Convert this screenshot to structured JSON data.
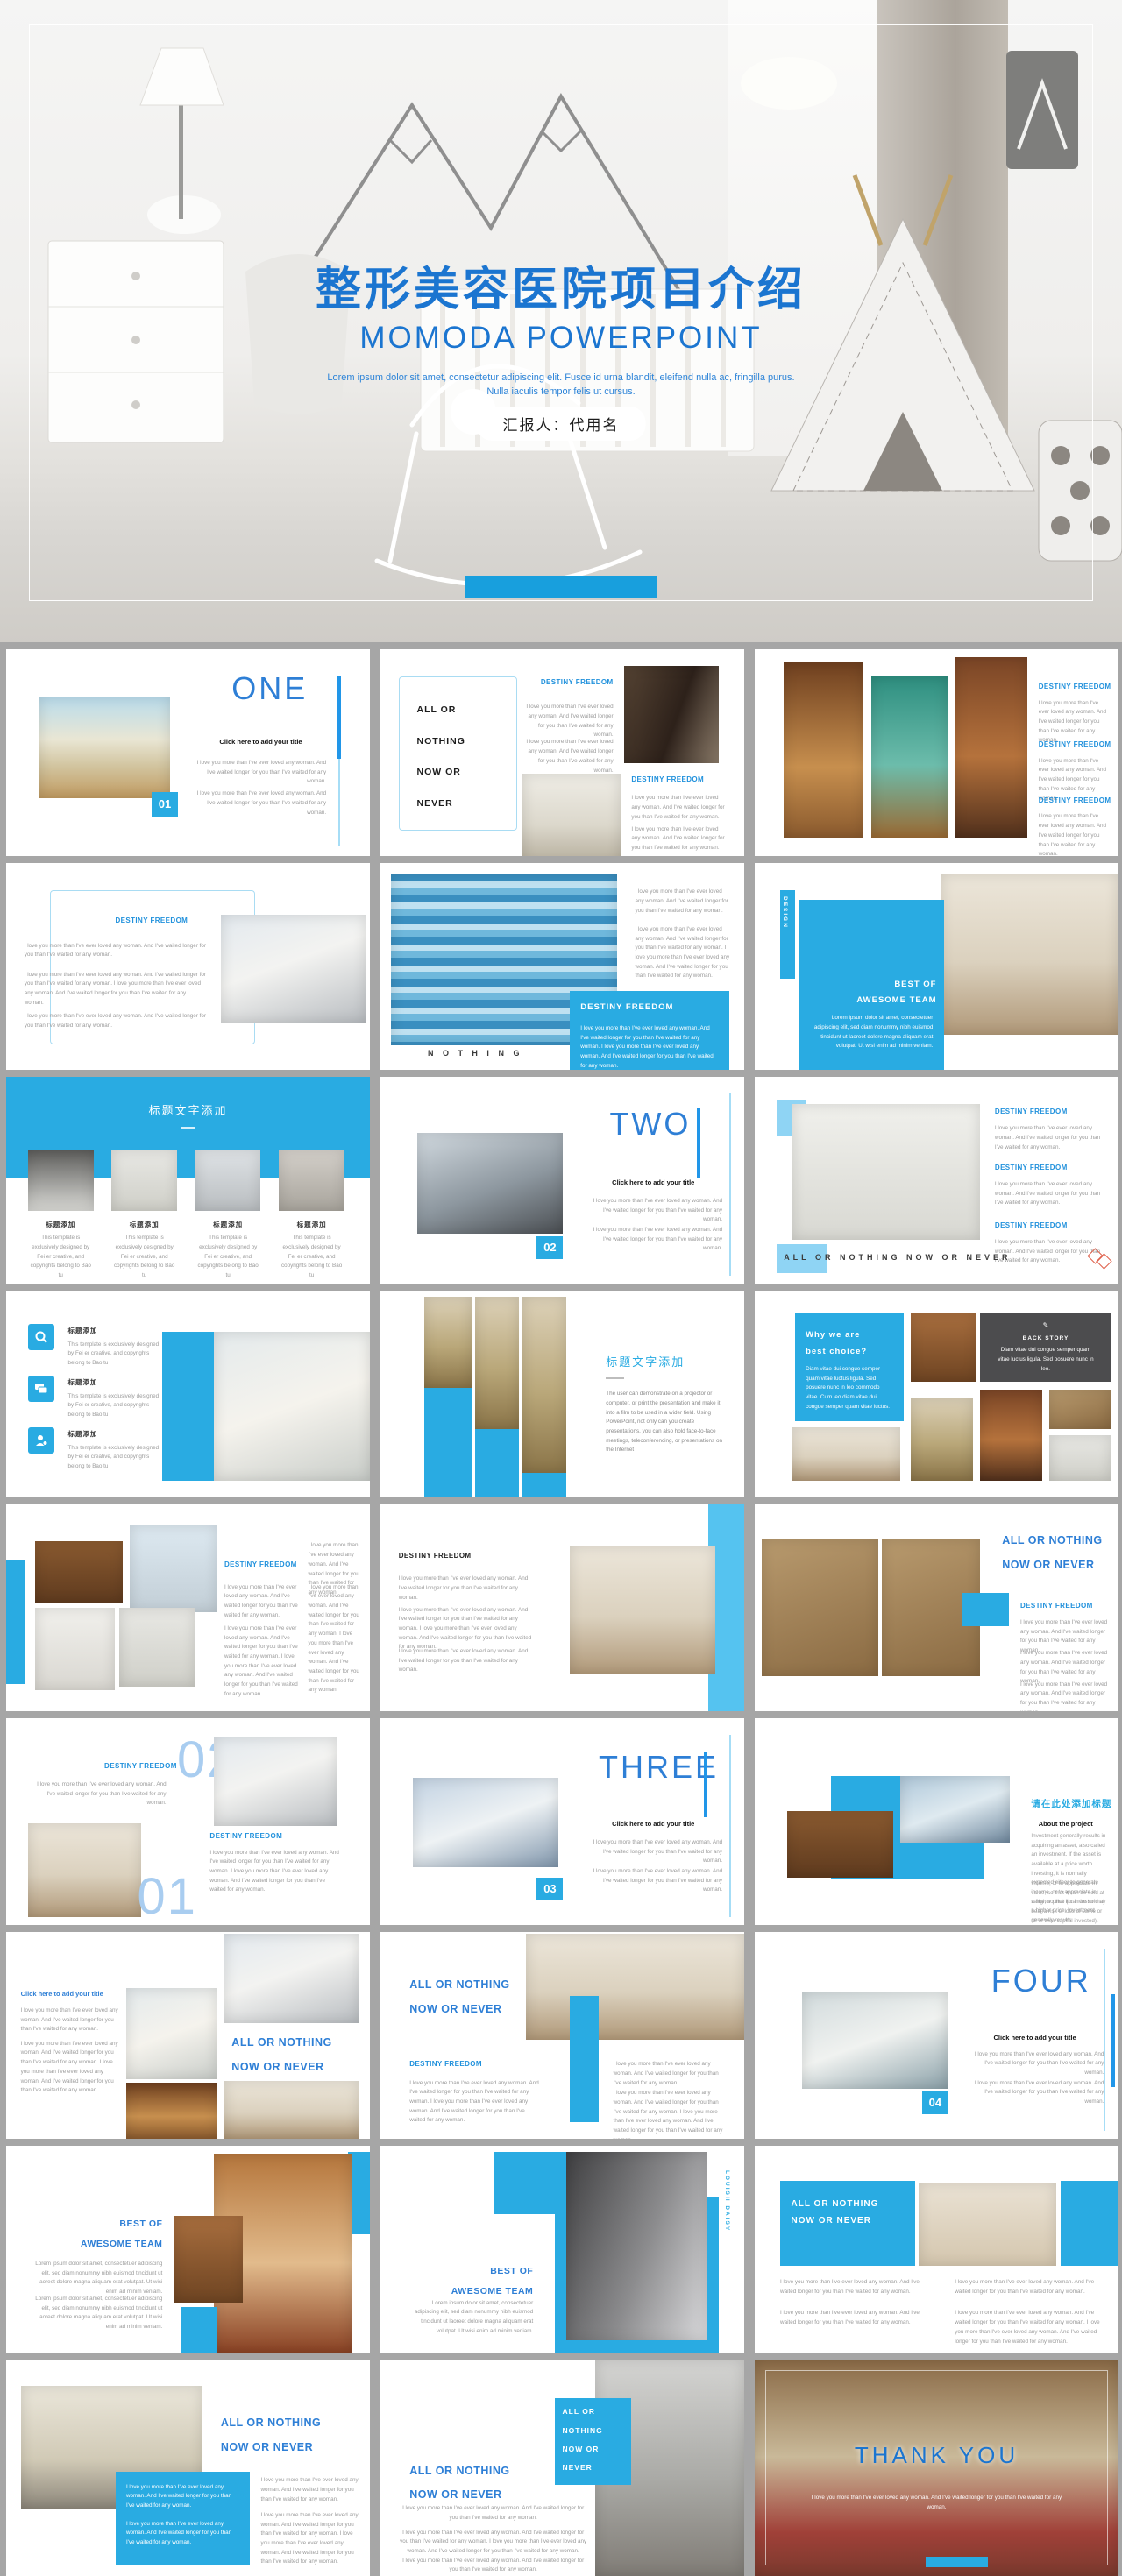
{
  "palette": {
    "accent": "#29abe2",
    "accent_dark": "#1b75d0",
    "accent_light": "#8fd4f4",
    "heading_blue": "#2191dc",
    "word_blue": "#2e7fd6",
    "page_bg": "#a6a6a6",
    "diamond_orange": "#e0604a"
  },
  "hero": {
    "title": "整形美容医院项目介绍",
    "subtitle": "MOMODA POWERPOINT",
    "desc": "Lorem ipsum dolor sit amet, consectetur adipiscing elit. Fusce id urna blandit, eleifend nulla ac, fringilla purus. Nulla iaculis tempor felis ut cursus.",
    "presenter": "汇报人：代用名"
  },
  "common": {
    "destiny": "DESTINY FREEDOM",
    "click": "Click here to add your title",
    "love": "I love you more than I've ever loved any woman. And I've waited longer for you than I've waited for any woman.",
    "lovelong": "I love you more than I've ever loved any woman. And I've waited longer for you than I've waited for any woman. I love you more than I've ever loved any woman. And I've waited longer for you than I've waited for any woman.",
    "caption": "This template is exclusively designed by Fei er creative, and copyrights belong to Bao tu",
    "lorem": "Lorem ipsum dolor sit amet, consectetuer adipiscing elit, sed diam nonummy nibh euismod tincidunt ut laoreet dolore magna aliquam erat volutpat. Ut wisi enim ad minim veniam.",
    "all1": "ALL OR",
    "all2": "NOTHING",
    "all3": "NOW OR",
    "all4": "NEVER",
    "allA": "ALL OR NOTHING",
    "allB": "NOW OR NEVER",
    "allFull": "ALL OR NOTHING NOW OR NEVER",
    "nothing": "N O T H I N G",
    "best1": "BEST OF",
    "best2": "AWESOME TEAM",
    "why1": "Why we are",
    "why2": "best choice?",
    "whytext": "Diam vitae dui congue semper quam vitae luctus ligula. Sed posuere nunc in leo commodo vitae. Cum leo diam vitae dui congue semper quam vitae luctus.",
    "backstory": "BACK STORY",
    "backtext": "Diam vitae dui congue semper quam vitae luctus ligula. Sed posuere nunc in leo.",
    "projector": "The user can demonstrate on a projector or computer, or print the presentation and make it into a film to be used in a wider field. Using PowerPoint, not only can you create presentations, you can also hold face-to-face meetings, teleconferencing, or presentations on the Internet",
    "title_cn": "标题添加",
    "header_cn": "标题文字添加",
    "add_title_cn": "请在此处添加标题",
    "about": "About the project",
    "invest1": "Investment generally results in acquiring an asset, also called an investment. If the asset is available at a price worth investing, it is normally expected either to generate income, or to appreciate in value, so that it can be sold at a higher price. Investment generally results.",
    "invest2": "Income, or to appreciate in value, so that it can be sold at a higher price (or investor may bear a risk of loss of some or all of their capital invested).",
    "design_vertical": "DESIGN",
    "louish_vertical": "LOUISH DAISY",
    "thank": "THANK YOU"
  },
  "numbers": {
    "one": "ONE",
    "two": "TWO",
    "three": "THREE",
    "four": "FOUR",
    "big01": "01",
    "big02": "02"
  },
  "badges": {
    "b01": "01",
    "b02": "02",
    "b03": "03",
    "b04": "04"
  }
}
